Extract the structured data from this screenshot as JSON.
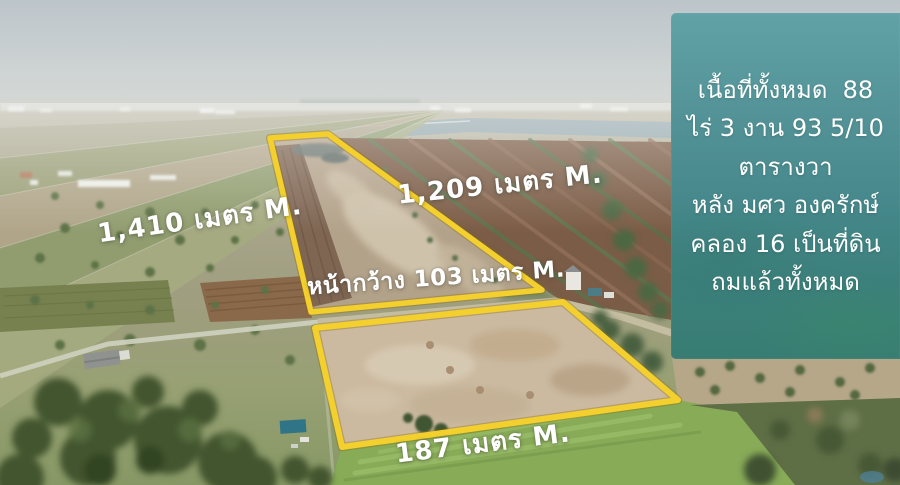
{
  "measurements": {
    "left_side": "1,410 เมตร M.",
    "upper_right_side": "1,209 เมตร M.",
    "front_width": "หน้ากว้าง 103 เมตร M.",
    "bottom_side": "187 เมตร M."
  },
  "info_panel": {
    "lines": [
      "เนื้อที่ทั้งหมด  88",
      "ไร่ 3 งาน 93 5/10",
      "ตารางวา",
      "หลัง มศว องครักษ์",
      "คลอง 16 เป็นที่ดิน",
      "ถมแล้วทั้งหมด"
    ]
  },
  "colors": {
    "parcel_outline_yellow": "#f3d02d",
    "info_panel_teal_top": "#5ba1a5",
    "info_panel_teal_bottom": "#387d73",
    "label_text": "#ffffff"
  }
}
